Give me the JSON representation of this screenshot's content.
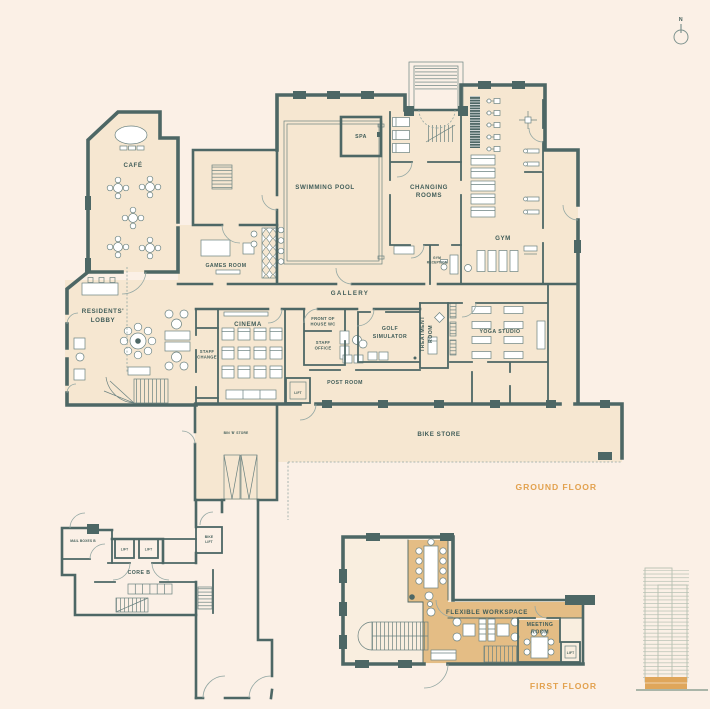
{
  "compass": {
    "north_label": "N"
  },
  "colors": {
    "background": "#fbf0e6",
    "floor_fill": "#f6e7d1",
    "floor_fill_light": "#f9eedf",
    "highlight_fill": "#e4bd85",
    "wall": "#4d6765",
    "label_text": "#415d59",
    "accent_text": "#e2a14e",
    "furniture_stroke": "#6b8280",
    "elevation_stroke": "#b5c0b2",
    "elevation_highlight": "#dfa65b"
  },
  "ground_floor": {
    "floor_label": "GROUND FLOOR",
    "rooms": {
      "cafe": "CAFÉ",
      "games_room": "GAMES ROOM",
      "spa": "SPA",
      "swimming_pool": "SWIMMING POOL",
      "changing_rooms": [
        "CHANGING",
        "ROOMS"
      ],
      "gym": "GYM",
      "gym_reception": [
        "GYM",
        "RECEPTION"
      ],
      "gallery": "GALLERY",
      "residents_lobby": [
        "RESIDENTS'",
        "LOBBY"
      ],
      "staff_change": [
        "STAFF",
        "CHANGE"
      ],
      "cinema": "CINEMA",
      "front_of_house_wc": [
        "FRONT OF",
        "HOUSE WC"
      ],
      "staff_office": [
        "STAFF",
        "OFFICE"
      ],
      "golf_simulator": [
        "GOLF",
        "SIMULATOR"
      ],
      "treatment_room": [
        "TREATMENT",
        "ROOM"
      ],
      "yoga_studio": "YOGA STUDIO",
      "post_room": "POST ROOM",
      "lift": "LIFT",
      "bin_store": "BIN 'B' STORE",
      "bike_store": "BIKE STORE"
    }
  },
  "core_b": {
    "name": "CORE B",
    "mail_boxes": "MAIL BOXES B",
    "lifts": [
      "LIFT",
      "LIFT"
    ],
    "bike_lift": [
      "BIKE",
      "LIFT"
    ]
  },
  "first_floor": {
    "floor_label": "FIRST FLOOR",
    "rooms": {
      "flexible_workspace": "FLEXIBLE WORKSPACE",
      "meeting_room": [
        "MEETING",
        "ROOM"
      ],
      "lift": "LIFT"
    }
  }
}
